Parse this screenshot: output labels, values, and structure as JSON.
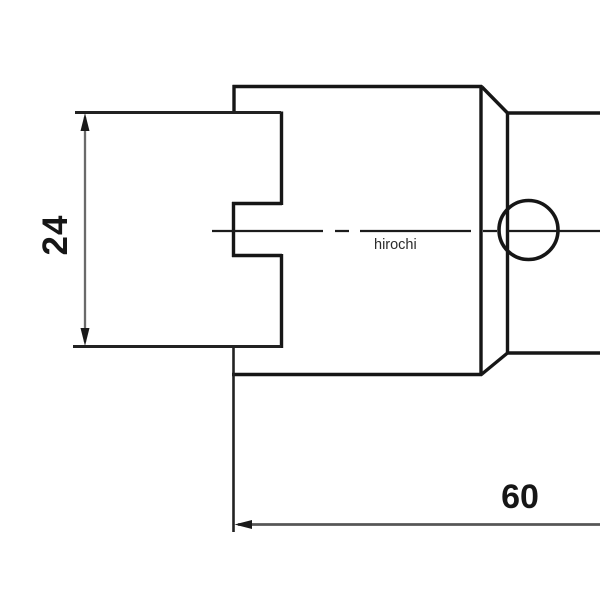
{
  "page": {
    "background": "#ffffff"
  },
  "drawing": {
    "type": "technical-drawing",
    "view": "side-profile-of-stepped-cylindrical-part",
    "watermark": "hirochi",
    "dimensions": [
      {
        "label": "24",
        "orientation": "vertical",
        "measures": "height of left recess opening"
      },
      {
        "label": "60",
        "orientation": "horizontal",
        "measures": "length from left step face rightward"
      }
    ],
    "features": [
      "large-cylinder-body",
      "left-end-recess-with-center-tab",
      "right-chamfered-transition",
      "small-right-cylinder",
      "cross-hole-circle",
      "dash-dot-centerline"
    ]
  },
  "colors": {
    "outline": "#161616",
    "extension_line": "#222222",
    "dimension_line": "#6a6a6a",
    "dimension_line_bottom": "#565656",
    "centerline": "#1c1c1c",
    "arrow": "#1a1a1a",
    "dimension_text": "#161616",
    "watermark_text": "#2b2b2b",
    "background": "#ffffff"
  }
}
